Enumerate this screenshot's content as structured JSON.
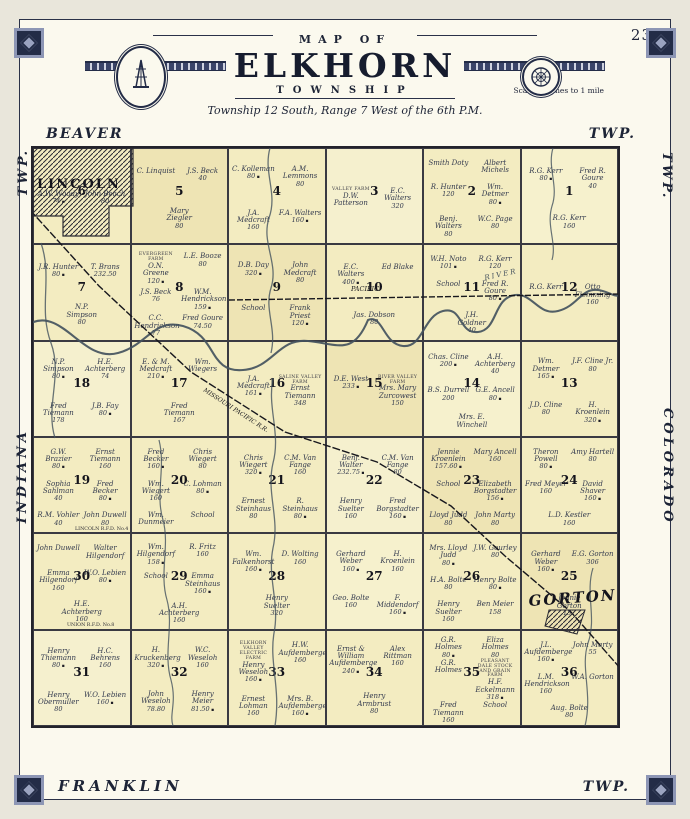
{
  "page": {
    "number": "23"
  },
  "header": {
    "arc_title": "MAP OF",
    "title": "ELKHORN",
    "subtitle": "TOWNSHIP",
    "scale": "Scale 2 inches to 1 mile",
    "legal": "Township 12 South, Range 7 West of the 6th P.M."
  },
  "edge_labels": {
    "top_left": "BEAVER",
    "top_right": "TWP.",
    "bottom_left": "FRANKLIN",
    "bottom_right": "TWP.",
    "left_top": "TWP.",
    "left_bottom": "INDIANA",
    "right_top": "TWP.",
    "right_bottom": "COLORADO"
  },
  "towns": [
    {
      "name": "LINCOLN"
    },
    {
      "name": "GORTON"
    }
  ],
  "railroads": [
    {
      "label": "PACIFIC"
    },
    {
      "label": "MISSOURI PACIFIC R.R."
    }
  ],
  "roads": [
    {
      "label": "LINCOLN R.F.D. No.4"
    },
    {
      "label": "UNION R.F.D. No.8"
    }
  ],
  "water": [
    {
      "label": "RIVER"
    }
  ],
  "colors": {
    "paper": "#fbf9ee",
    "map": "#f3ecc1",
    "border": "#26304b",
    "ink": "#2e3340"
  },
  "sections": [
    {
      "number": 6,
      "parcels": [
        {
          "name": "A.W. Woody",
          "acres": "74"
        },
        {
          "name": "John Beach",
          "acres": "80"
        }
      ]
    },
    {
      "number": 5,
      "parcels": [
        {
          "name": "C. Linquist"
        },
        {
          "name": "J.S. Beck",
          "acres": "40"
        },
        {
          "name": "Mary Ziegler",
          "acres": "80"
        }
      ]
    },
    {
      "number": 4,
      "parcels": [
        {
          "name": "C. Kolleman",
          "acres": "80"
        },
        {
          "name": "A.M. Lemmons",
          "acres": "80"
        },
        {
          "name": "J.A. Medcraft",
          "acres": "160"
        },
        {
          "name": "F.A. Walters",
          "acres": "160"
        }
      ]
    },
    {
      "number": 3,
      "parcels": [
        {
          "name": "D.W. Patterson",
          "farm": "VALLEY FARM"
        },
        {
          "name": "E.C. Walters",
          "acres": "320"
        }
      ]
    },
    {
      "number": 2,
      "parcels": [
        {
          "name": "Smith Doty"
        },
        {
          "name": "Albert Michels"
        },
        {
          "name": "R. Hunter",
          "acres": "120"
        },
        {
          "name": "Wm. Detmer",
          "acres": "80"
        },
        {
          "name": "Benj. Walters",
          "acres": "80"
        },
        {
          "name": "W.C. Page",
          "acres": "80"
        }
      ]
    },
    {
      "number": 1,
      "parcels": [
        {
          "name": "R.G. Kerr",
          "acres": "80"
        },
        {
          "name": "Fred R. Goure",
          "acres": "40"
        },
        {
          "name": "R.G. Kerr",
          "acres": "160"
        }
      ]
    },
    {
      "number": 7,
      "parcels": [
        {
          "name": "J.R. Hunter",
          "acres": "80"
        },
        {
          "name": "T. Brans",
          "acres": "232.50"
        },
        {
          "name": "N.P. Simpson",
          "acres": "80"
        }
      ]
    },
    {
      "number": 8,
      "parcels": [
        {
          "name": "O.N. Greene",
          "acres": "120",
          "farm": "EVERGREEN FARM"
        },
        {
          "name": "L.E. Booze",
          "acres": "80"
        },
        {
          "name": "J.S. Beck",
          "acres": "76"
        },
        {
          "name": "W.M. Hendrickson",
          "acres": "159"
        },
        {
          "name": "C.C. Hendrickson",
          "acres": "77"
        },
        {
          "name": "Fred Goure",
          "acres": "74.50"
        }
      ]
    },
    {
      "number": 9,
      "parcels": [
        {
          "name": "D.B. Day",
          "acres": "320"
        },
        {
          "name": "John Medcraft",
          "acres": "80"
        },
        {
          "name": "School"
        },
        {
          "name": "Frank Priest",
          "acres": "120"
        }
      ]
    },
    {
      "number": 10,
      "parcels": [
        {
          "name": "E.C. Walters",
          "acres": "400"
        },
        {
          "name": "Ed Blake"
        },
        {
          "name": "Jas. Dobson",
          "acres": "80"
        }
      ]
    },
    {
      "number": 11,
      "parcels": [
        {
          "name": "W.H. Noto",
          "acres": "101"
        },
        {
          "name": "R.G. Kerr",
          "acres": "120"
        },
        {
          "name": "School"
        },
        {
          "name": "Fred R. Goure",
          "acres": "80"
        },
        {
          "name": "J.H. Goldner",
          "acres": "40"
        }
      ]
    },
    {
      "number": 12,
      "parcels": [
        {
          "name": "R.G. Kerr"
        },
        {
          "name": "Otto Flemming",
          "acres": "160"
        }
      ]
    },
    {
      "number": 18,
      "parcels": [
        {
          "name": "N.P. Simpson",
          "acres": "80"
        },
        {
          "name": "H.E. Achterberg",
          "acres": "74"
        },
        {
          "name": "Fred Tiemann",
          "acres": "178"
        },
        {
          "name": "J.B. Fay",
          "acres": "80"
        }
      ]
    },
    {
      "number": 17,
      "parcels": [
        {
          "name": "E. & M. Medcraft",
          "acres": "210"
        },
        {
          "name": "Wm. Wiegers"
        },
        {
          "name": "Fred Tiemann",
          "acres": "167"
        }
      ]
    },
    {
      "number": 16,
      "parcels": [
        {
          "name": "J.A. Medcraft",
          "acres": "161"
        },
        {
          "name": "Ernst Tiemann",
          "acres": "348",
          "farm": "SALINE VALLEY FARM"
        }
      ]
    },
    {
      "number": 15,
      "parcels": [
        {
          "name": "D.E. West",
          "acres": "233"
        },
        {
          "name": "Mrs. Mary Zurcowest",
          "acres": "150",
          "farm": "RIVER VALLEY FARM"
        }
      ]
    },
    {
      "number": 14,
      "parcels": [
        {
          "name": "Chas. Cline",
          "acres": "200"
        },
        {
          "name": "A.H. Achterberg",
          "acres": "40"
        },
        {
          "name": "B.S. Durrell",
          "acres": "200"
        },
        {
          "name": "G.E. Ancell",
          "acres": "80"
        },
        {
          "name": "Mrs. E. Winchell"
        }
      ]
    },
    {
      "number": 13,
      "parcels": [
        {
          "name": "Wm. Detmer",
          "acres": "165"
        },
        {
          "name": "J.F. Cline Jr.",
          "acres": "80"
        },
        {
          "name": "J.D. Cline",
          "acres": "80"
        },
        {
          "name": "H. Kroenlein",
          "acres": "320"
        }
      ]
    },
    {
      "number": 19,
      "parcels": [
        {
          "name": "G.W. Brazier",
          "acres": "80"
        },
        {
          "name": "Ernst Tiemann",
          "acres": "160"
        },
        {
          "name": "Sophia Sahlman",
          "acres": "40"
        },
        {
          "name": "Fred Becker",
          "acres": "80"
        },
        {
          "name": "R.M. Vohler",
          "acres": "40"
        },
        {
          "name": "John Duwell",
          "acres": "80"
        }
      ]
    },
    {
      "number": 20,
      "parcels": [
        {
          "name": "Fred Becker",
          "acres": "160"
        },
        {
          "name": "Chris Wiegert",
          "acres": "80"
        },
        {
          "name": "Wm. Wiegert",
          "acres": "160"
        },
        {
          "name": "C. Lohman",
          "acres": "80"
        },
        {
          "name": "Wm. Dunmeier"
        },
        {
          "name": "School"
        }
      ]
    },
    {
      "number": 21,
      "parcels": [
        {
          "name": "Chris Wiegert",
          "acres": "320"
        },
        {
          "name": "C.M. Van Fange",
          "acres": "160"
        },
        {
          "name": "Ernest Steinhaus",
          "acres": "80"
        },
        {
          "name": "R. Steinhaus",
          "acres": "80"
        }
      ]
    },
    {
      "number": 22,
      "parcels": [
        {
          "name": "Benj. Walter",
          "acres": "232.75"
        },
        {
          "name": "C.M. Van Fange",
          "acres": "80"
        },
        {
          "name": "Henry Suelter",
          "acres": "160"
        },
        {
          "name": "Fred Borgstadter",
          "acres": "160"
        }
      ]
    },
    {
      "number": 23,
      "parcels": [
        {
          "name": "Jennie Kroenlein",
          "acres": "157.60"
        },
        {
          "name": "Mary Ancell",
          "acres": "160"
        },
        {
          "name": "School"
        },
        {
          "name": "Elizabeth Borgstadter",
          "acres": "156"
        },
        {
          "name": "Lloyd Judd",
          "acres": "80"
        },
        {
          "name": "John Marty",
          "acres": "80"
        }
      ]
    },
    {
      "number": 24,
      "parcels": [
        {
          "name": "Theron Powell",
          "acres": "80"
        },
        {
          "name": "Amy Hartell",
          "acres": "80"
        },
        {
          "name": "Fred Meyer",
          "acres": "160"
        },
        {
          "name": "David Shaver",
          "acres": "160"
        },
        {
          "name": "L.D. Kestler",
          "acres": "160"
        }
      ]
    },
    {
      "number": 30,
      "parcels": [
        {
          "name": "John Duwell"
        },
        {
          "name": "Walter Hilgendorf"
        },
        {
          "name": "Emma Hilgendorf",
          "acres": "160"
        },
        {
          "name": "W.O. Lebien",
          "acres": "80"
        },
        {
          "name": "H.E. Achterberg",
          "acres": "160"
        }
      ]
    },
    {
      "number": 29,
      "parcels": [
        {
          "name": "Wm. Hilgendorf",
          "acres": "158"
        },
        {
          "name": "R. Fritz",
          "acres": "160"
        },
        {
          "name": "School"
        },
        {
          "name": "Emma Steinhaus",
          "acres": "160"
        },
        {
          "name": "A.H. Achterberg",
          "acres": "160"
        }
      ]
    },
    {
      "number": 28,
      "parcels": [
        {
          "name": "Wm. Falkenhorst",
          "acres": "160"
        },
        {
          "name": "D. Wolting",
          "acres": "160"
        },
        {
          "name": "Henry Suelter",
          "acres": "320"
        }
      ]
    },
    {
      "number": 27,
      "parcels": [
        {
          "name": "Gerhard Weber",
          "acres": "160"
        },
        {
          "name": "H. Kroenlein",
          "acres": "160"
        },
        {
          "name": "Geo. Bolte",
          "acres": "160"
        },
        {
          "name": "F. Middendorf",
          "acres": "160"
        }
      ]
    },
    {
      "number": 26,
      "parcels": [
        {
          "name": "Mrs. Lloyd Judd",
          "acres": "80"
        },
        {
          "name": "J.W. Gourley",
          "acres": "80"
        },
        {
          "name": "H.A. Bolte",
          "acres": "80"
        },
        {
          "name": "Henry Bolte",
          "acres": "80"
        },
        {
          "name": "Henry Suelter",
          "acres": "160"
        },
        {
          "name": "Ben Meier",
          "acres": "158"
        }
      ]
    },
    {
      "number": 25,
      "parcels": [
        {
          "name": "Gerhard Weber",
          "acres": "160"
        },
        {
          "name": "E.G. Gorton",
          "acres": "306"
        },
        {
          "name": "Jennie Gorton",
          "acres": "157"
        }
      ]
    },
    {
      "number": 31,
      "parcels": [
        {
          "name": "Henry Thiemann",
          "acres": "80"
        },
        {
          "name": "H.C. Behrens",
          "acres": "160"
        },
        {
          "name": "Henry Obermuller",
          "acres": "80"
        },
        {
          "name": "W.O. Lebien",
          "acres": "160"
        }
      ]
    },
    {
      "number": 32,
      "parcels": [
        {
          "name": "H. Kruckenberg",
          "acres": "320"
        },
        {
          "name": "W.C. Weseloh",
          "acres": "160"
        },
        {
          "name": "John Weseloh",
          "acres": "78.80"
        },
        {
          "name": "Henry Meier",
          "acres": "81.50"
        }
      ]
    },
    {
      "number": 33,
      "parcels": [
        {
          "name": "Henry Weseloh",
          "acres": "160",
          "farm": "ELKHORN VALLEY ELECTRIC FARM"
        },
        {
          "name": "H.W. Aufdemberge",
          "acres": "160"
        },
        {
          "name": "Ernest Lohman",
          "acres": "160"
        },
        {
          "name": "Mrs. B. Aufdemberge",
          "acres": "160"
        }
      ]
    },
    {
      "number": 34,
      "parcels": [
        {
          "name": "Ernst & William Aufdemberge",
          "acres": "240"
        },
        {
          "name": "Alex Rittman",
          "acres": "160"
        },
        {
          "name": "Henry Armbrust",
          "acres": "80"
        }
      ]
    },
    {
      "number": 35,
      "parcels": [
        {
          "name": "G.R. Holmes",
          "acres": "80"
        },
        {
          "name": "Eliza Holmes",
          "acres": "80"
        },
        {
          "name": "G.R. Holmes"
        },
        {
          "name": "H.F. Eckelmann",
          "acres": "318",
          "farm": "PLEASANT DALE STOCK AND GRAIN FARM"
        },
        {
          "name": "Fred Tiemann",
          "acres": "160"
        },
        {
          "name": "School"
        }
      ]
    },
    {
      "number": 36,
      "parcels": [
        {
          "name": "J.L. Aufdemberge",
          "acres": "160"
        },
        {
          "name": "John Marty",
          "acres": "55"
        },
        {
          "name": "L.M. Hendrickson",
          "acres": "160"
        },
        {
          "name": "W.A. Gorton"
        },
        {
          "name": "Aug. Bolte",
          "acres": "80"
        }
      ]
    }
  ]
}
